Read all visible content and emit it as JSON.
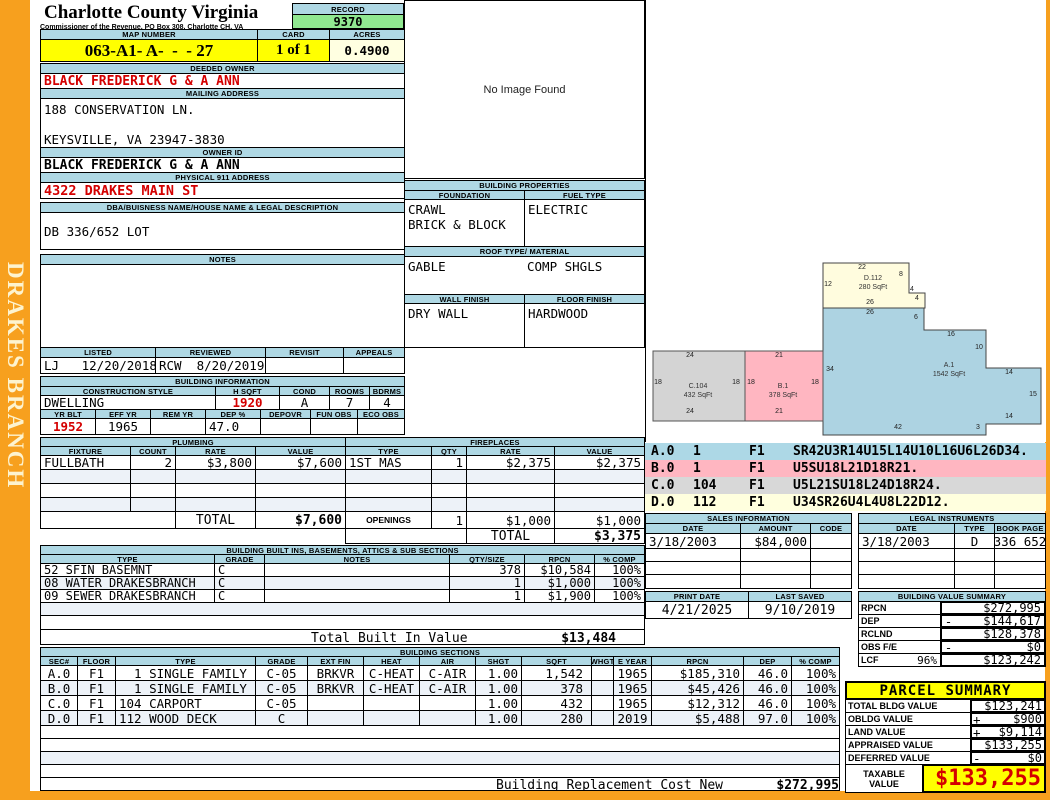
{
  "frame": {
    "district": "DRAKES BRANCH"
  },
  "header": {
    "county": "Charlotte County Virginia",
    "commissioner": "Commissioner of the Revenue, PO Box 308, Charlotte CH, VA",
    "record_label": "RECORD",
    "record_value": "9370",
    "map_label": "MAP NUMBER",
    "map_value": "063-A1- A-  -  - 27",
    "card_label": "CARD",
    "card_value": "1 of 1",
    "acres_label": "ACRES",
    "acres_value": "0.4900"
  },
  "owner": {
    "deeded_label": "DEEDED OWNER",
    "deeded": "BLACK FREDERICK G & A ANN",
    "mailing_label": "MAILING ADDRESS",
    "mailing_line1": "188 CONSERVATION LN.",
    "mailing_line2": "KEYSVILLE, VA 23947-3830",
    "owner_id_label": "OWNER ID",
    "owner_id": "BLACK FREDERICK G & A ANN",
    "physical_label": "PHYSICAL 911 ADDRESS",
    "physical": "4322 DRAKES MAIN ST",
    "dba_label": "DBA/BUISNESS NAME/HOUSE NAME & LEGAL DESCRIPTION",
    "legal_description": "DB 336/652 LOT",
    "notes_label": "NOTES",
    "notes": ""
  },
  "review": {
    "headers": [
      "LISTED",
      "REVIEWED",
      "REVISIT",
      "APPEALS"
    ],
    "values": [
      "LJ   12/20/2018",
      "RCW  8/20/2019",
      "",
      ""
    ]
  },
  "building_info": {
    "title": "BUILDING INFORMATION",
    "row1_headers": [
      "CONSTRUCTION STYLE",
      "H SQFT",
      "COND",
      "ROOMS",
      "BDRMS"
    ],
    "row1_values": [
      "DWELLING",
      "1920",
      "A",
      "7",
      "4"
    ],
    "row2_headers": [
      "YR BLT",
      "EFF YR",
      "REM YR",
      "DEP %",
      "DEPOVR",
      "FUN OBS",
      "ECO OBS"
    ],
    "row2_values": [
      "1952",
      "1965",
      "",
      "47.0",
      "",
      "",
      ""
    ]
  },
  "plumbing": {
    "title": "PLUMBING",
    "headers": [
      "FIXTURE",
      "COUNT",
      "RATE",
      "VALUE"
    ],
    "rows": [
      [
        "FULLBATH",
        "2",
        "$3,800",
        "$7,600"
      ],
      [
        "",
        "",
        "",
        ""
      ],
      [
        "",
        "",
        "",
        ""
      ],
      [
        "",
        "",
        "",
        ""
      ]
    ],
    "total_label": "TOTAL",
    "total": "$7,600"
  },
  "fireplaces": {
    "title": "FIREPLACES",
    "headers": [
      "TYPE",
      "QTY",
      "RATE",
      "VALUE"
    ],
    "rows": [
      [
        "1ST MAS",
        "1",
        "$2,375",
        "$2,375"
      ],
      [
        "",
        "",
        "",
        ""
      ],
      [
        "",
        "",
        "",
        ""
      ],
      [
        "",
        "",
        "",
        ""
      ]
    ],
    "openings": [
      "OPENINGS",
      "1",
      "$1,000",
      "$1,000"
    ],
    "total_label": "TOTAL",
    "total": "$3,375"
  },
  "properties": {
    "title": "BUILDING PROPERTIES",
    "foundation_label": "FOUNDATION",
    "foundation_line1": "CRAWL",
    "foundation_line2": "BRICK & BLOCK",
    "fuel_label": "FUEL TYPE",
    "fuel": "ELECTRIC",
    "roof_label": "ROOF TYPE/ MATERIAL",
    "roof_type": "GABLE",
    "roof_material": "COMP SHGLS",
    "wall_label": "WALL FINISH",
    "wall": "DRY WALL",
    "floor_label": "FLOOR FINISH",
    "floor": "HARDWOOD"
  },
  "built_ins": {
    "title": "BUILDING BUILT INS, BASEMENTS, ATTICS & SUB SECTIONS",
    "headers": [
      "TYPE",
      "GRADE",
      "NOTES",
      "QTY/SIZE",
      "RPCN",
      "% COMP"
    ],
    "rows": [
      [
        "52 SFIN BASEMNT",
        "C",
        "",
        "378",
        "$10,584",
        "100%"
      ],
      [
        "08 WATER DRAKESBRANCH",
        "C",
        "",
        "1",
        "$1,000",
        "100%"
      ],
      [
        "09 SEWER DRAKESBRANCH",
        "C",
        "",
        "1",
        "$1,900",
        "100%"
      ]
    ],
    "total_label": "Total Built In Value",
    "total": "$13,484"
  },
  "sections": {
    "title": "BUILDING SECTIONS",
    "headers": [
      "SEC#",
      "FLOOR",
      "TYPE",
      "GRADE",
      "EXT FIN",
      "HEAT",
      "AIR",
      "SHGT",
      "SQFT",
      "WHGT",
      "E YEAR",
      "RPCN",
      "DEP",
      "% COMP"
    ],
    "rows": [
      [
        "A.0",
        "F1",
        "  1 SINGLE FAMILY",
        "C-05",
        "BRKVR",
        "C-HEAT",
        "C-AIR",
        "1.00",
        "1,542",
        "",
        "1965",
        "$185,310",
        "46.0",
        "100%"
      ],
      [
        "B.0",
        "F1",
        "  1 SINGLE FAMILY",
        "C-05",
        "BRKVR",
        "C-HEAT",
        "C-AIR",
        "1.00",
        "378",
        "",
        "1965",
        "$45,426",
        "46.0",
        "100%"
      ],
      [
        "C.0",
        "F1",
        "104 CARPORT",
        "C-05",
        "",
        "",
        "",
        "1.00",
        "432",
        "",
        "1965",
        "$12,312",
        "46.0",
        "100%"
      ],
      [
        "D.0",
        "F1",
        "112 WOOD DECK",
        "C",
        "",
        "",
        "",
        "1.00",
        "280",
        "",
        "2019",
        "$5,488",
        "97.0",
        "100%"
      ]
    ],
    "replacement_label": "Building Replacement Cost New",
    "replacement_value": "$272,995"
  },
  "sketch": {
    "no_image": "No Image Found",
    "vectors": [
      {
        "sec": "A.0",
        "code": "1",
        "floor": "F1",
        "path": "SR42U3R14U15L14U10L16U6L26D34.",
        "color": "#ADD8E6"
      },
      {
        "sec": "B.0",
        "code": "1",
        "floor": "F1",
        "path": "U5SU18L21D18R21.",
        "color": "#FFB6C1"
      },
      {
        "sec": "C.0",
        "code": "104",
        "floor": "F1",
        "path": "U5L21SU18L24D18R24.",
        "color": "#D8D8D8"
      },
      {
        "sec": "D.0",
        "code": "112",
        "floor": "F1",
        "path": "U34SR26U4L4U8L22D12.",
        "color": "#FFFFDE"
      }
    ],
    "shapes": {
      "a_label": "A.1",
      "a_area": "1542 SqFt",
      "b_label": "B.1",
      "b_area": "378 SqFt",
      "c_label": "C.104",
      "c_area": "432 SqFt",
      "d_label": "D.112",
      "d_area": "280 SqFt"
    },
    "dims": [
      {
        "t": "24",
        "x": 44,
        "y": 352
      },
      {
        "t": "18",
        "x": 12,
        "y": 379
      },
      {
        "t": "18",
        "x": 90,
        "y": 379
      },
      {
        "t": "24",
        "x": 44,
        "y": 408
      },
      {
        "t": "21",
        "x": 133,
        "y": 352
      },
      {
        "t": "18",
        "x": 105,
        "y": 379
      },
      {
        "t": "18",
        "x": 169,
        "y": 379
      },
      {
        "t": "21",
        "x": 133,
        "y": 408
      },
      {
        "t": "34",
        "x": 184,
        "y": 366
      },
      {
        "t": "26",
        "x": 224,
        "y": 309
      },
      {
        "t": "6",
        "x": 270,
        "y": 314
      },
      {
        "t": "16",
        "x": 305,
        "y": 331
      },
      {
        "t": "10",
        "x": 333,
        "y": 344
      },
      {
        "t": "14",
        "x": 363,
        "y": 369
      },
      {
        "t": "15",
        "x": 387,
        "y": 391
      },
      {
        "t": "14",
        "x": 363,
        "y": 413
      },
      {
        "t": "3",
        "x": 332,
        "y": 424
      },
      {
        "t": "42",
        "x": 252,
        "y": 424
      },
      {
        "t": "22",
        "x": 216,
        "y": 264
      },
      {
        "t": "12",
        "x": 182,
        "y": 281
      },
      {
        "t": "8",
        "x": 255,
        "y": 271
      },
      {
        "t": "4",
        "x": 266,
        "y": 286
      },
      {
        "t": "4",
        "x": 271,
        "y": 295
      },
      {
        "t": "26",
        "x": 224,
        "y": 299
      }
    ]
  },
  "sales": {
    "title": "SALES INFORMATION",
    "headers": [
      "DATE",
      "AMOUNT",
      "CODE"
    ],
    "rows": [
      [
        "3/18/2003",
        "$84,000",
        ""
      ]
    ]
  },
  "legal": {
    "title": "LEGAL INSTRUMENTS",
    "headers": [
      "DATE",
      "TYPE",
      "BOOK PAGE"
    ],
    "rows": [
      [
        "3/18/2003",
        "D",
        "336 652"
      ]
    ]
  },
  "print_info": {
    "print_label": "PRINT DATE",
    "print_date": "4/21/2025",
    "saved_label": "LAST SAVED",
    "last_saved": "9/10/2019"
  },
  "value_summary": {
    "title": "BUILDING VALUE SUMMARY",
    "rows": [
      {
        "label": "RPCN",
        "pct": "",
        "sign": "",
        "value": "$272,995"
      },
      {
        "label": "DEP",
        "pct": "",
        "sign": "-",
        "value": "$144,617"
      },
      {
        "label": "RCLND",
        "pct": "",
        "sign": "",
        "value": "$128,378"
      },
      {
        "label": "OBS F/E",
        "pct": "",
        "sign": "-",
        "value": "$0"
      },
      {
        "label": "LCF",
        "pct": "96%",
        "sign": "",
        "value": "$123,242"
      }
    ]
  },
  "parcel_summary": {
    "title": "PARCEL SUMMARY",
    "rows": [
      {
        "label": "TOTAL BLDG VALUE",
        "sign": "",
        "value": "$123,241"
      },
      {
        "label": "OBLDG VALUE",
        "sign": "+",
        "value": "$900"
      },
      {
        "label": "LAND VALUE",
        "sign": "+",
        "value": "$9,114"
      },
      {
        "label": "APPRAISED VALUE",
        "sign": "",
        "value": "$133,255"
      },
      {
        "label": "DEFERRED VALUE",
        "sign": "-",
        "value": "$0"
      }
    ],
    "taxable_label_line1": "TAXABLE",
    "taxable_label_line2": "VALUE",
    "taxable": "$133,255"
  },
  "colors": {
    "accent_orange": "#F7A01E",
    "header_blue": "#AFD8E4",
    "record_green": "#90E890",
    "highlight_yellow": "#FFFF00",
    "cream": "#FFFFE1",
    "red": "#D40000",
    "sketch_blue": "#ADD3E2",
    "sketch_pink": "#FFB6C1",
    "sketch_gray": "#D4D4D4",
    "sketch_yellow": "#FFFCDE"
  }
}
